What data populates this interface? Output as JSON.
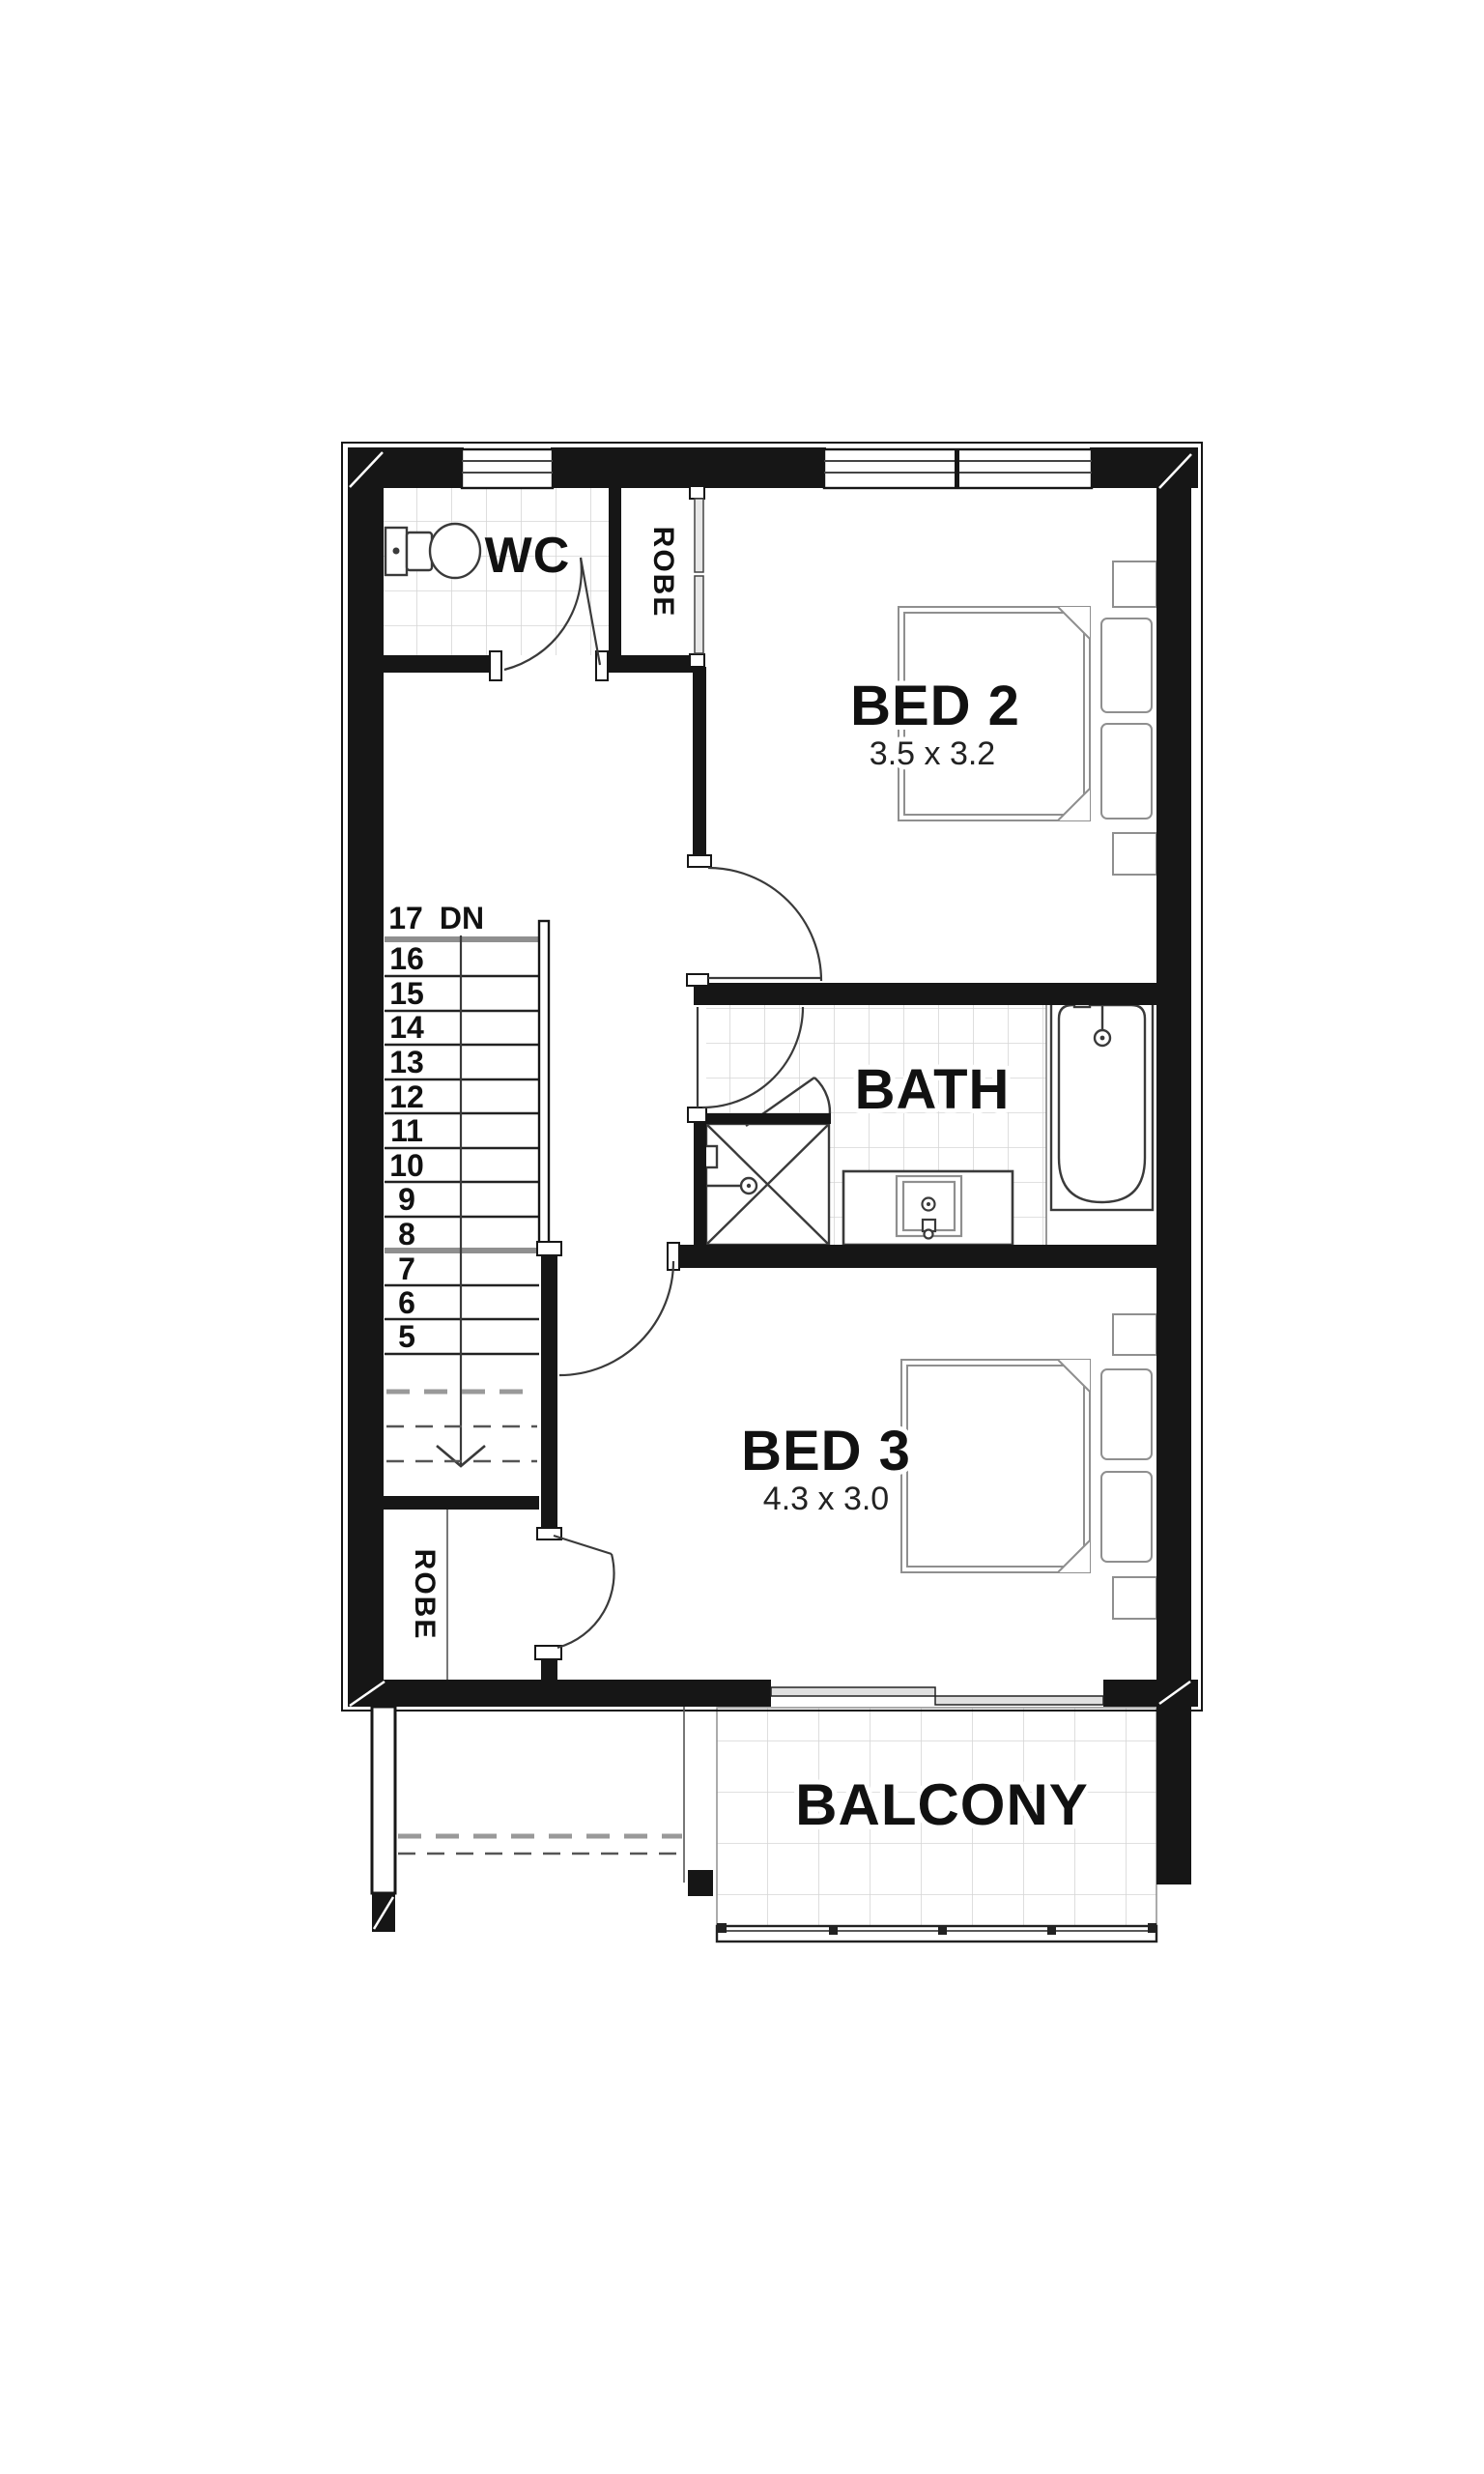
{
  "plan": {
    "rooms": {
      "wc": {
        "label": "WC"
      },
      "robe_top": {
        "label": "ROBE"
      },
      "bed2": {
        "label": "BED 2",
        "dims": "3.5 x 3.2"
      },
      "bath": {
        "label": "BATH"
      },
      "bed3": {
        "label": "BED 3",
        "dims": "4.3 x 3.0"
      },
      "robe_bottom": {
        "label": "ROBE"
      },
      "balcony": {
        "label": "BALCONY"
      }
    },
    "stairs": {
      "top_number": "17",
      "direction": "DN",
      "tread_labels": [
        "16",
        "15",
        "14",
        "13",
        "12",
        "11",
        "10",
        "9",
        "8",
        "7",
        "6",
        "5"
      ]
    },
    "colors": {
      "wall": "#161616",
      "door_line": "#3a3a3a",
      "furniture_line": "#8f8f8f",
      "tile_line": "#d6d6d6"
    }
  }
}
